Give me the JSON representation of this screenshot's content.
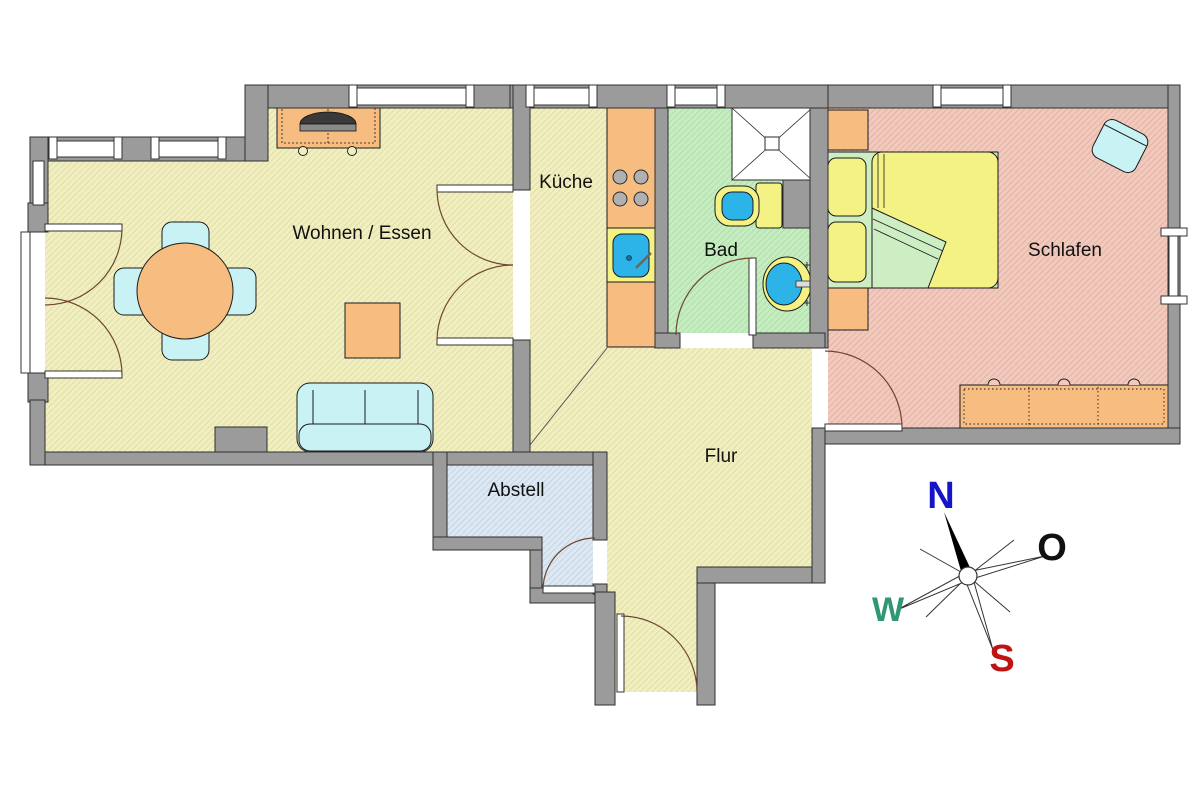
{
  "rooms": {
    "living": {
      "label": "Wohnen / Essen"
    },
    "kitchen": {
      "label": "Küche"
    },
    "bath": {
      "label": "Bad"
    },
    "bedroom": {
      "label": "Schlafen"
    },
    "hall": {
      "label": "Flur"
    },
    "storage": {
      "label": "Abstell"
    }
  },
  "compass": {
    "north": "N",
    "east": "O",
    "south": "S",
    "west": "W"
  },
  "colors": {
    "wall": "#9b9b9b",
    "floor_living_kitchen_hall": "#f1efc0",
    "floor_bath": "#c5edc0",
    "floor_bedroom": "#f2c9bd",
    "floor_storage": "#dce8f3",
    "furniture_wood": "#f7bd80",
    "furniture_upholstery": "#c9f2f4",
    "bed_linen": "#cdedc3",
    "mattress_pillow": "#f5f285",
    "sanitary_fixture": "#2cb4e8",
    "compass_north": "#1414c8",
    "compass_east": "#111111",
    "compass_west": "#2f9676",
    "compass_south": "#c01414"
  }
}
